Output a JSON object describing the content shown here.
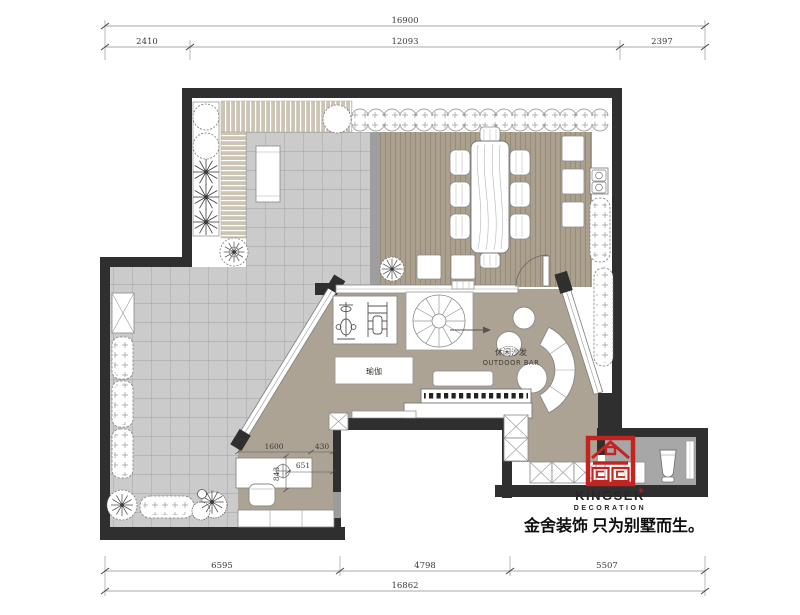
{
  "dims_top": {
    "total": "16900",
    "seg1": "2410",
    "seg2": "12093",
    "seg3": "2397"
  },
  "dims_bottom": {
    "seg1": "6595",
    "seg2": "4798",
    "seg3": "5507",
    "total": "16862"
  },
  "dims_study": {
    "width": "1600",
    "gap": "430",
    "diag": "651",
    "depth": "843"
  },
  "labels": {
    "yoga": "瑜伽",
    "lounge_cn": "休闲沙发",
    "lounge_en": "OUTDOOR BAR"
  },
  "logo": {
    "brand": "KINGSER",
    "mark": "®",
    "division": "DECORATION",
    "slogan": "金舍装饰 只为别墅而生。",
    "seal_color": "#c32420"
  },
  "colors": {
    "wall": "#2f2f2f",
    "tile": "#cbcbcb",
    "wood_floor": "#aba08e",
    "lounge_floor": "#ada395",
    "bath_floor": "#a7a7a7",
    "deck": "#ccc4b4"
  }
}
